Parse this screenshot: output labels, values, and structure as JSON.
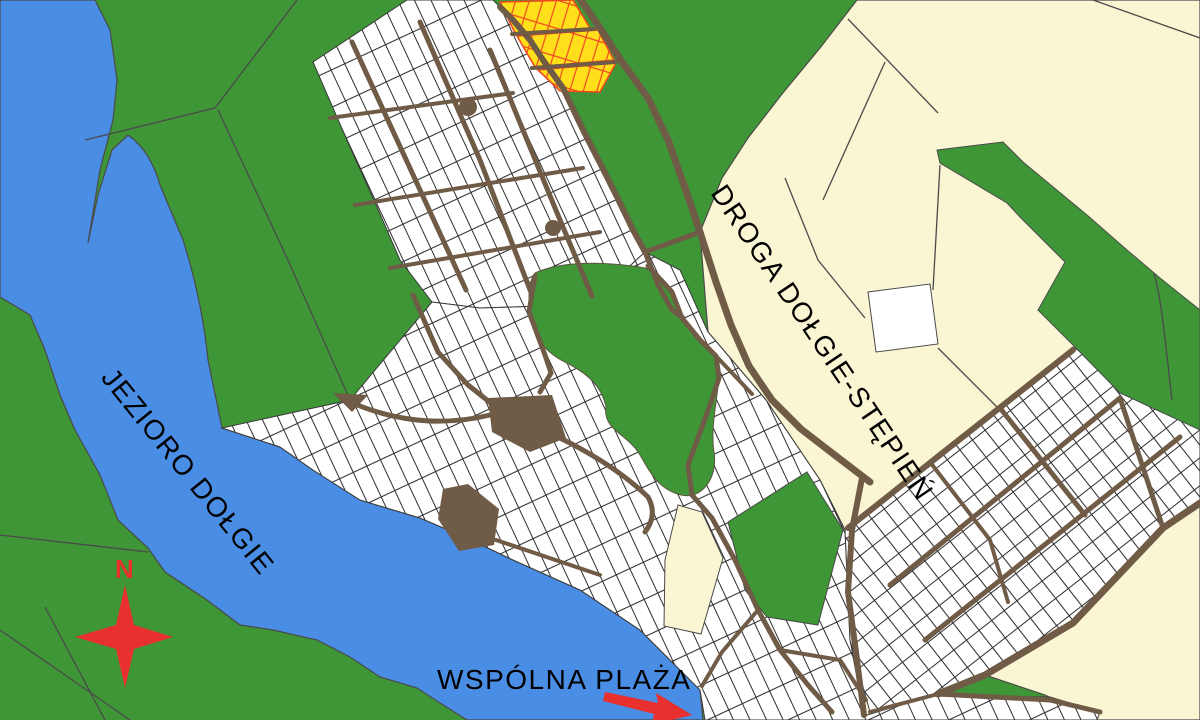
{
  "map": {
    "labels": {
      "lake": "JEZIORO DOŁGIE",
      "road": "DROGA DOŁGIE-STĘPIEŃ",
      "beach": "WSPÓLNA PLAŻA"
    },
    "compass": {
      "north_letter": "N"
    },
    "colors": {
      "water": "#4a8de4",
      "forest": "#3e9636",
      "field": "#faf5d2",
      "road": "#6f5b46",
      "parcel_fill": "#ffffff",
      "parcel_line": "#2e2e2e",
      "boundary_line": "#4a4a4a",
      "highlight_parcel_fill": "#ffdf1a",
      "highlight_parcel_line": "#f04822",
      "compass_color": "#e8312e",
      "arrow_color": "#e8312e",
      "label_color": "#000000"
    }
  }
}
